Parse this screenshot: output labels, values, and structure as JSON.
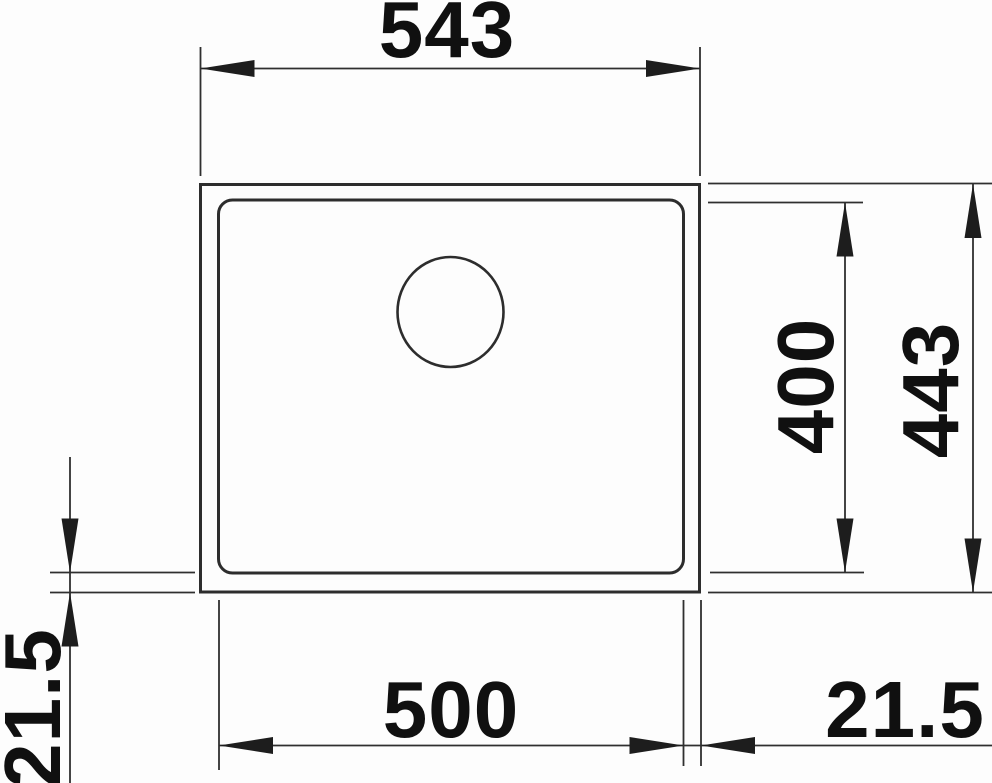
{
  "drawing": {
    "kind": "technical-dimension-drawing",
    "subject": "sink-bowl-top-view-with-drain-hole",
    "units": "mm",
    "labels": {
      "outer_width": "543",
      "bowl_width": "500",
      "bowl_depth": "400",
      "outer_depth": "443",
      "rim_left": "21.5",
      "rim_right": "21.5"
    },
    "colors": {
      "line": "#2d2d2d",
      "text": "#101010",
      "background": "#fdfdfd"
    }
  }
}
